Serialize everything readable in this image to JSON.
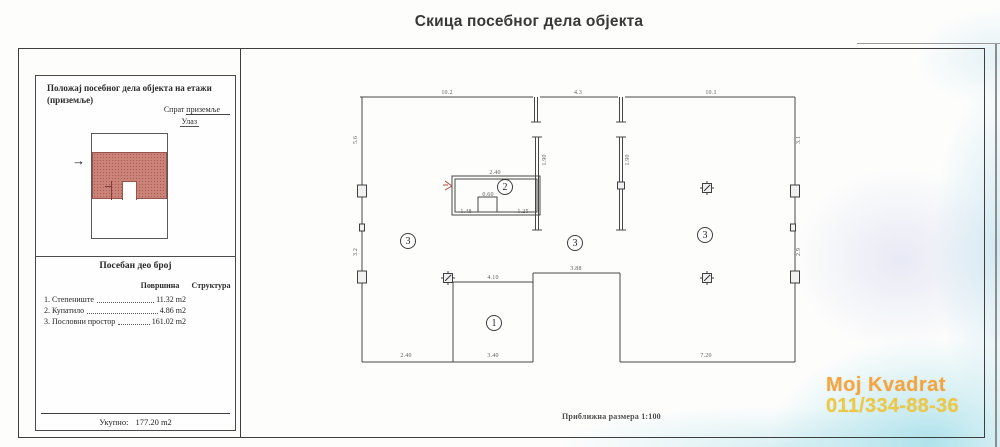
{
  "title": "Скица посебног дела објекта",
  "panel": {
    "heading": "Положај посебног дела објекта на етажи (приземље)",
    "floor_label": "Спрат",
    "floor_value": "приземље",
    "entrance_label": "Улаз",
    "section_heading": "Посебан део број",
    "col_area": "Површина",
    "col_structure": "Структура",
    "items": [
      {
        "name": "1. Степениште",
        "area": "11.32 m2"
      },
      {
        "name": "2. Купатило",
        "area": "4.86 m2"
      },
      {
        "name": "3. Пословни простор",
        "area": "161.02 m2"
      }
    ],
    "total_label": "Укупно:",
    "total_value": "177.20 m2"
  },
  "plan": {
    "scale_note": "Приближна размера 1:100",
    "room_markers": [
      {
        "num": "1",
        "x": 494,
        "y": 323
      },
      {
        "num": "2",
        "x": 505,
        "y": 187
      },
      {
        "num": "3",
        "x": 408,
        "y": 241
      },
      {
        "num": "3",
        "x": 575,
        "y": 243
      },
      {
        "num": "3",
        "x": 705,
        "y": 235
      }
    ],
    "dimension_labels": [
      {
        "text": "10.2",
        "x": 447,
        "y": 93,
        "rotate": false
      },
      {
        "text": "4.3",
        "x": 578,
        "y": 93,
        "rotate": false
      },
      {
        "text": "10.1",
        "x": 711,
        "y": 93,
        "rotate": false
      },
      {
        "text": "5.6",
        "x": 356,
        "y": 140,
        "rotate": true
      },
      {
        "text": "3.2",
        "x": 356,
        "y": 252,
        "rotate": true
      },
      {
        "text": "2.40",
        "x": 495,
        "y": 173,
        "rotate": false
      },
      {
        "text": "0.60",
        "x": 488,
        "y": 195,
        "rotate": false
      },
      {
        "text": "1.48",
        "x": 466,
        "y": 212,
        "rotate": false
      },
      {
        "text": "1.25",
        "x": 523,
        "y": 212,
        "rotate": false
      },
      {
        "text": "4.10",
        "x": 493,
        "y": 278,
        "rotate": false
      },
      {
        "text": "3.40",
        "x": 493,
        "y": 356,
        "rotate": false
      },
      {
        "text": "2.40",
        "x": 406,
        "y": 356,
        "rotate": false
      },
      {
        "text": "3.88",
        "x": 576,
        "y": 269,
        "rotate": false
      },
      {
        "text": "7.20",
        "x": 706,
        "y": 356,
        "rotate": false
      },
      {
        "text": "3.1",
        "x": 799,
        "y": 140,
        "rotate": true
      },
      {
        "text": "2.9",
        "x": 799,
        "y": 252,
        "rotate": true
      },
      {
        "text": "1.90",
        "x": 545,
        "y": 160,
        "rotate": true
      },
      {
        "text": "1.90",
        "x": 628,
        "y": 160,
        "rotate": true
      }
    ]
  },
  "watermark": {
    "line1": "Moj Kvadrat",
    "line2": "011/334-88-36",
    "color": "#f2a43a"
  },
  "colors": {
    "highlight_red": "#cb837a",
    "scan_cyan": "#bfe6ee",
    "line": "#444444"
  }
}
